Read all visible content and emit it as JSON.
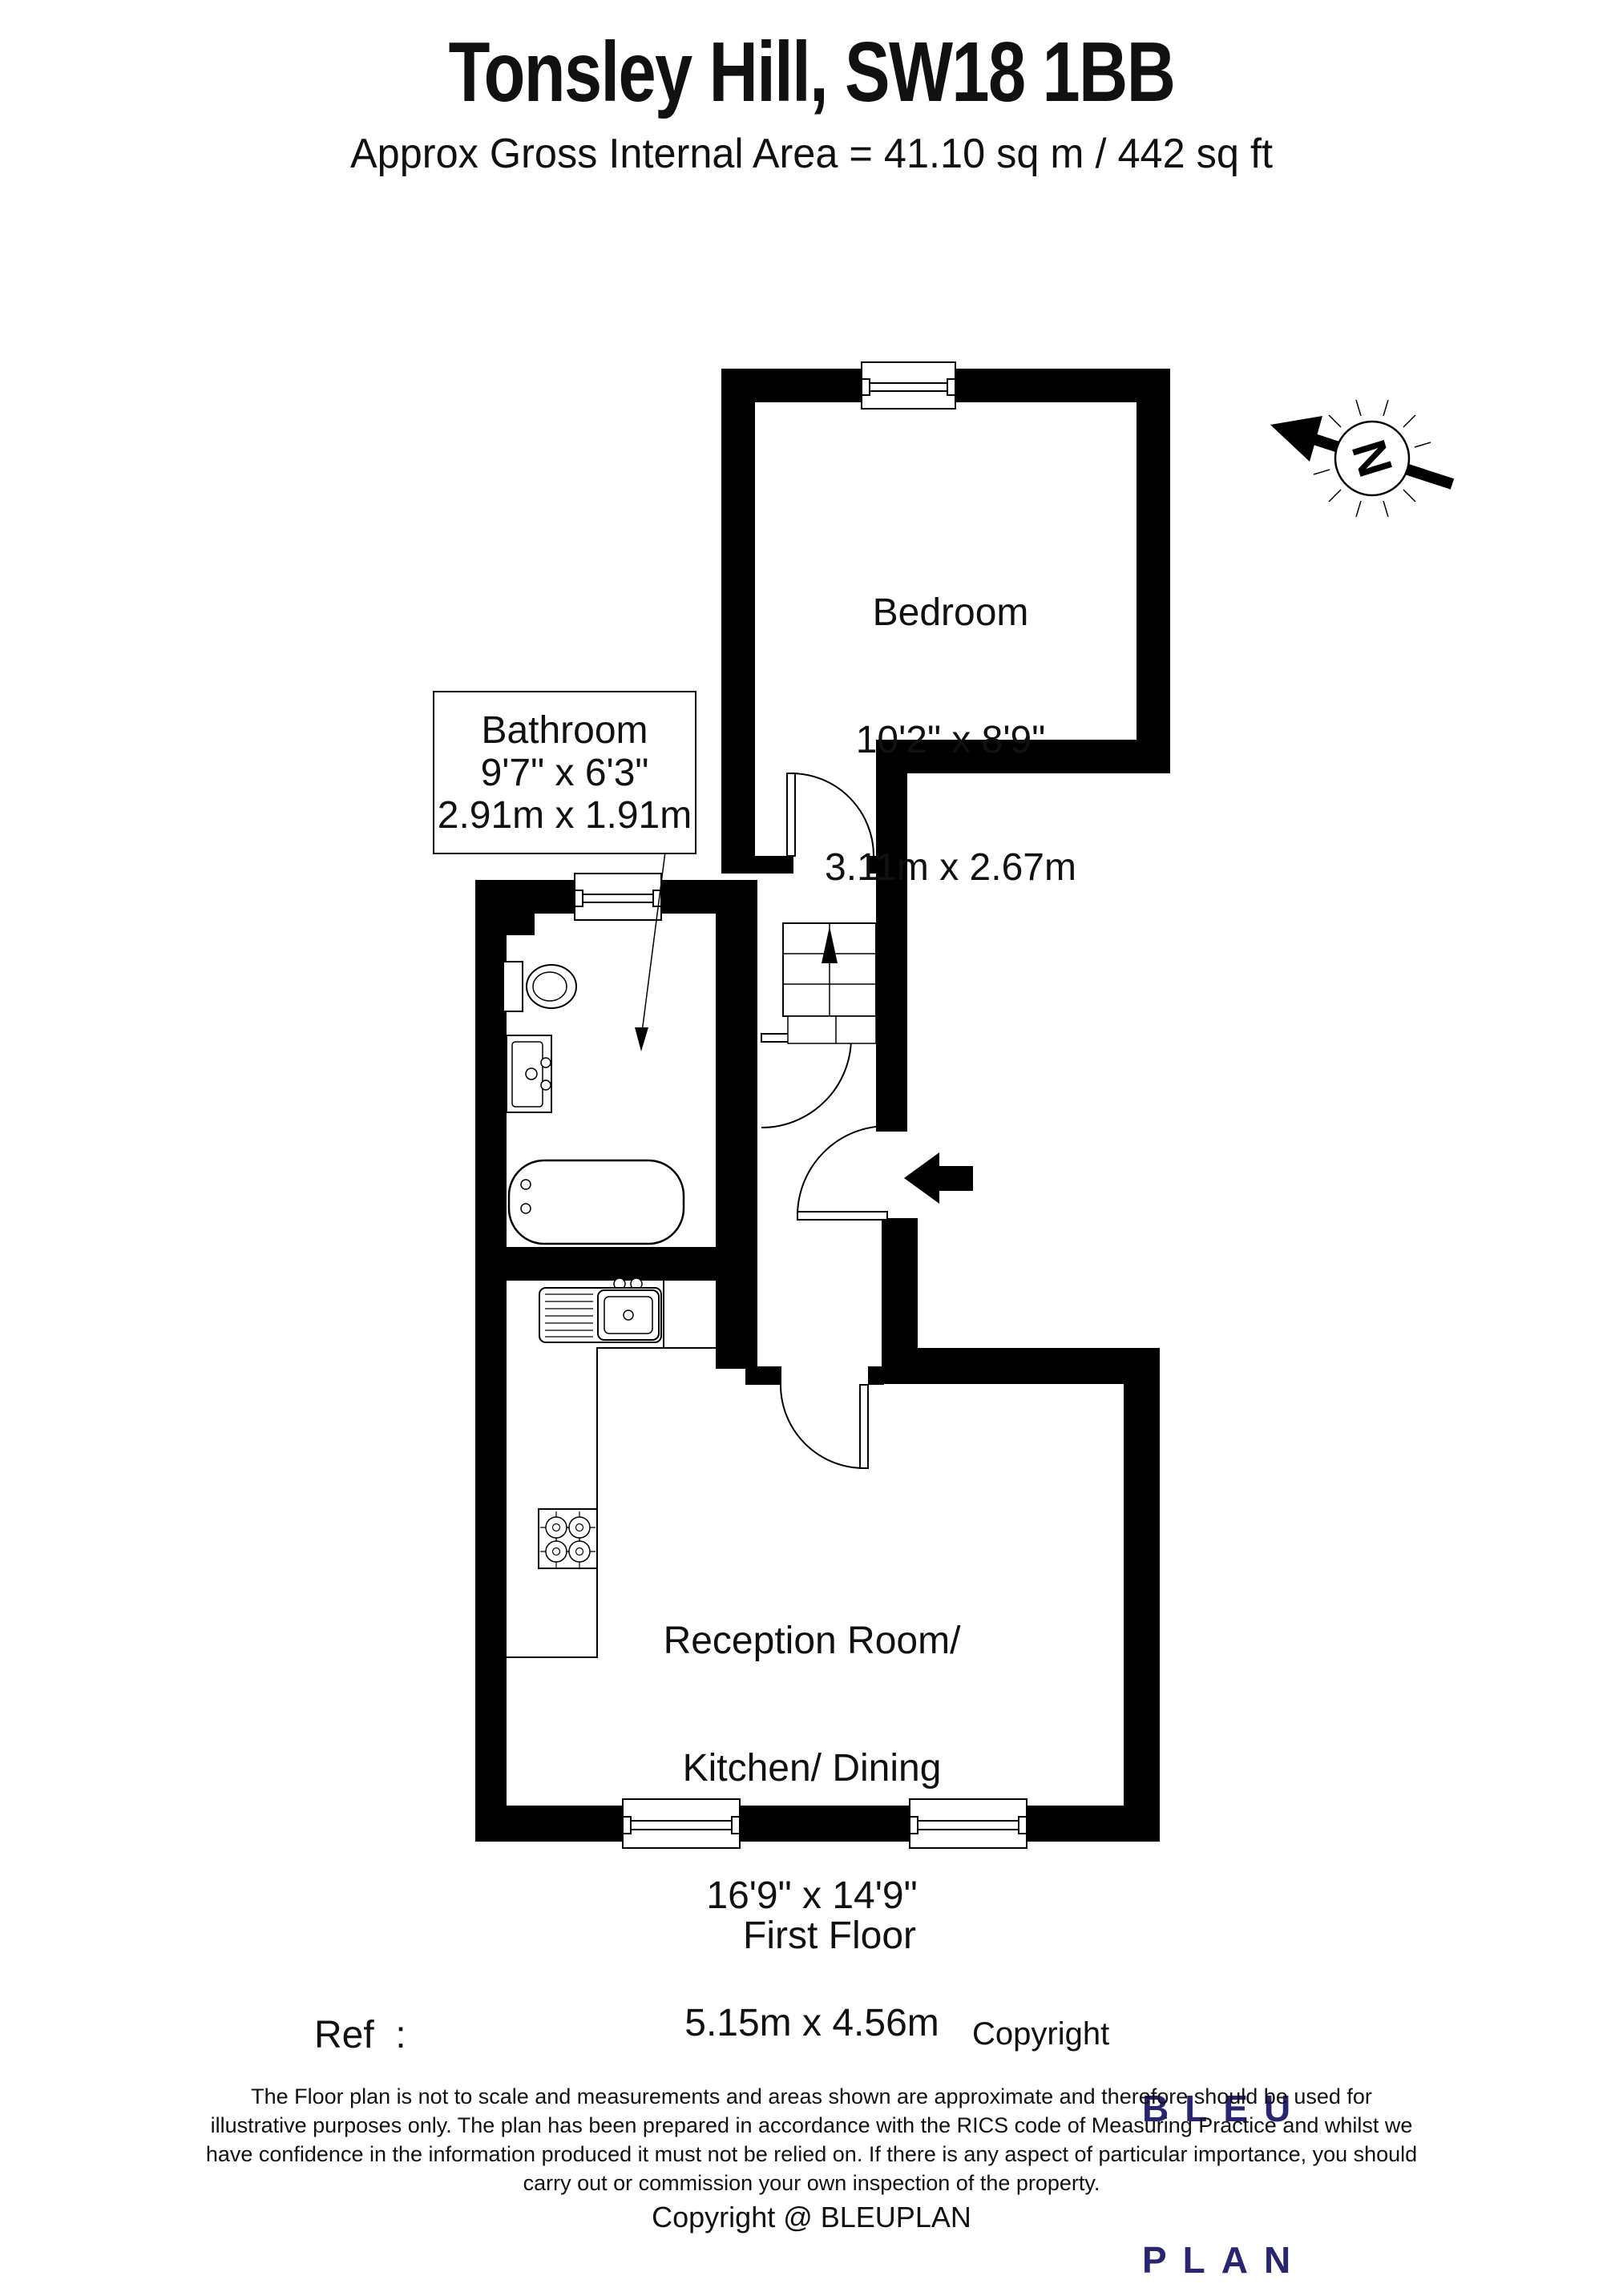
{
  "header": {
    "title": "Tonsley Hill, SW18 1BB",
    "subtitle": "Approx Gross Internal Area = 41.10 sq m / 442 sq ft"
  },
  "compass": {
    "label": "N"
  },
  "rooms": {
    "bedroom": {
      "name": "Bedroom",
      "imperial": "10'2\" x 8'9\"",
      "metric": "3.11m x 2.67m"
    },
    "bathroom": {
      "name": "Bathroom",
      "imperial": "9'7\" x 6'3\"",
      "metric": "2.91m x 1.91m"
    },
    "reception": {
      "name_line1": "Reception Room/",
      "name_line2": "Kitchen/ Dining",
      "imperial": "16'9\" x 14'9\"",
      "metric": "5.15m x 4.56m"
    }
  },
  "floor_label": "First Floor",
  "footer": {
    "ref_label": "Ref  :",
    "copyright_label": "Copyright",
    "logo_line1": "BLEU",
    "logo_line2": "PLAN",
    "disclaimer_line1": "The Floor plan is not to scale and measurements and areas shown are approximate and therefore should be used for",
    "disclaimer_line2": "illustrative purposes only. The plan has been prepared in accordance with the RICS code of Measuring Practice and whilst we",
    "disclaimer_line3": "have confidence in the information produced it must not be relied on. If there is any aspect of particular importance, you should",
    "disclaimer_line4": "carry out or commission your own inspection of the property.",
    "copyright_line": "Copyright @ BLEUPLAN"
  },
  "colors": {
    "wall": "#000000",
    "logo": "#2a2570"
  }
}
